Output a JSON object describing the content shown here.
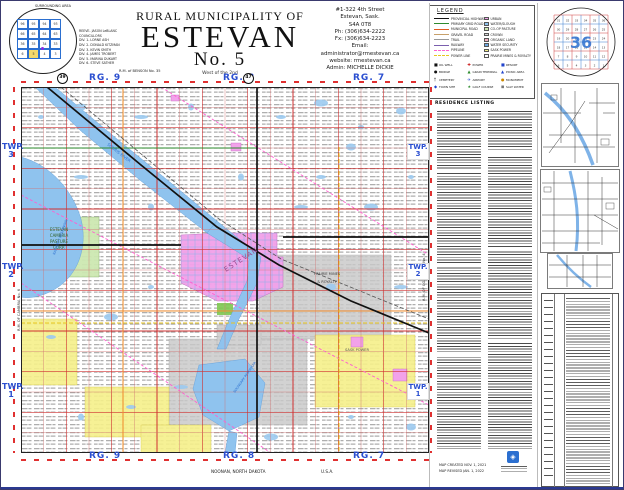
{
  "title_block": {
    "super": "RURAL MUNICIPALITY OF",
    "main": "ESTEVAN",
    "number": "No. 5",
    "meridian": "West of the 2nd",
    "north_neighbor": "R.M. of BENSON No. 35"
  },
  "contact": {
    "lines": [
      "#1-322  4th  Street",
      "Estevan, Sask.",
      "S4A 0T8",
      "Ph:  (306)634-2222",
      "Fx:  (306)634-2223",
      "Email:",
      "administrator@rmestevan.ca",
      "website:  rmestevan.ca",
      "Admin:  MICHELLE  DICKIE"
    ]
  },
  "council": {
    "lines": [
      "REEVE- JASON LeBLANC",
      "COUNCILLORS",
      "DIV. 1- LORNE ASH",
      "DIV. 2- DONALD KITZMAN",
      "DIV. 3- KEVIN SMITH",
      "DIV. 4- JAMES TROBERT",
      "DIV. 5- MARINA DUKART",
      "DIV. 6- STEVE SATHER"
    ]
  },
  "surrounding": {
    "title": "SURROUNDING AREA",
    "rows": [
      [
        "96",
        "95",
        "94",
        "93"
      ],
      [
        "66",
        "65",
        "64",
        "63"
      ],
      [
        "36",
        "35",
        "34",
        "33"
      ],
      [
        "6",
        "5",
        "4",
        "3"
      ]
    ],
    "highlight": "5"
  },
  "legend": {
    "title": "LEGEND",
    "lines": [
      {
        "label": "PROVINCIAL HIGHWAY",
        "color": "#111111",
        "dash": false
      },
      {
        "label": "PRIMARY GRID ROAD",
        "color": "#2e8b2e",
        "dash": false
      },
      {
        "label": "MUNICIPAL ROAD",
        "color": "#e05a20",
        "dash": false
      },
      {
        "label": "GRAVEL ROAD",
        "color": "#c8a06a",
        "dash": false
      },
      {
        "label": "TRAIL",
        "color": "#999999",
        "dash": false
      },
      {
        "label": "RAILWAY",
        "color": "#7a5fae",
        "dash": false
      },
      {
        "label": "PIPELINE",
        "color": "#ff5fd0",
        "dash": true
      },
      {
        "label": "POWER LINE",
        "color": "#e8c61e",
        "dash": true
      }
    ],
    "areas": [
      {
        "label": "URBAN",
        "color": "#f2a2ea"
      },
      {
        "label": "WATER/SLOUGH",
        "color": "#8fc3ee"
      },
      {
        "label": "CO-OP PASTURE",
        "color": "#cde8b2"
      },
      {
        "label": "CROWN",
        "color": "#d8d8d8"
      },
      {
        "label": "ORGANIC LAND",
        "color": "#f0b0c0"
      },
      {
        "label": "WATER SECURITY",
        "color": "#6fa8e0"
      },
      {
        "label": "SASK POWER",
        "color": "#f6f08a"
      },
      {
        "label": "PRAIRIE MINES & ROYALTY",
        "color": "#ffffff"
      }
    ],
    "symbols": [
      {
        "glyph": "■",
        "color": "#111111",
        "label": "OIL WELL"
      },
      {
        "glyph": "●",
        "color": "#111111",
        "label": "BRIDGE"
      },
      {
        "glyph": "†",
        "color": "#111111",
        "label": "CEMETERY"
      },
      {
        "glyph": "◆",
        "color": "#2244cc",
        "label": "TOWN SITE"
      },
      {
        "glyph": "✚",
        "color": "#cc2222",
        "label": "POWER"
      },
      {
        "glyph": "▲",
        "color": "#2e8b2e",
        "label": "GRAIN TERMINAL"
      },
      {
        "glyph": "✈",
        "color": "#2244cc",
        "label": "AIRPORT"
      },
      {
        "glyph": "★",
        "color": "#2e8b2e",
        "label": "GOLF COURSE"
      },
      {
        "glyph": "■",
        "color": "#2244cc",
        "label": "RESORT"
      },
      {
        "glyph": "▲",
        "color": "#2244cc",
        "label": "PICNIC AREA"
      },
      {
        "glyph": "●",
        "color": "#cc8800",
        "label": "MONUMENT"
      },
      {
        "glyph": "◼",
        "color": "#777777",
        "label": "SALT WATER"
      }
    ]
  },
  "map": {
    "rg": [
      "RG. 9",
      "RG. 8",
      "RG. 7"
    ],
    "twp": [
      "TWP. 3",
      "TWP. 2",
      "TWP. 1"
    ],
    "highways": [
      "39",
      "47"
    ],
    "labels": {
      "city": "ESTEVAN",
      "pasture": [
        "ESTEVAN",
        "CAMBRIA",
        "PASTURE",
        "CORP."
      ],
      "mines1": "PRAIRIE MINES",
      "mines2": "& ROYALTY",
      "power": "SASK POWER",
      "river": "SOURIS RIVER",
      "reservoir": "RAFFERTY RESERVOIR",
      "boundary": "BOUNDARY RESERVOIR",
      "east_rm": "R.M. OF COALFIELDS No. 4",
      "west_rm": "R.M. OF CAMBRIA No. 6"
    }
  },
  "footer": {
    "place": "NOONAN, NORTH DAKOTA",
    "country": "U.S.A."
  },
  "listing": {
    "title": "RESIDENCE LISTING",
    "created": "MAP CREATED NOV. 1, 2021",
    "revised": "MAP REVISED JAN. 1, 2022"
  },
  "inset_section": {
    "big": "36",
    "rows": [
      [
        "31",
        "32",
        "33",
        "34",
        "35",
        "36"
      ],
      [
        "30",
        "29",
        "28",
        "27",
        "26",
        "25"
      ],
      [
        "19",
        "20",
        "21",
        "22",
        "23",
        "24"
      ],
      [
        "18",
        "17",
        "16",
        "15",
        "14",
        "13"
      ],
      [
        "7",
        "8",
        "9",
        "10",
        "11",
        "12"
      ],
      [
        "6",
        "5",
        "4",
        "3",
        "2",
        "1"
      ]
    ]
  }
}
